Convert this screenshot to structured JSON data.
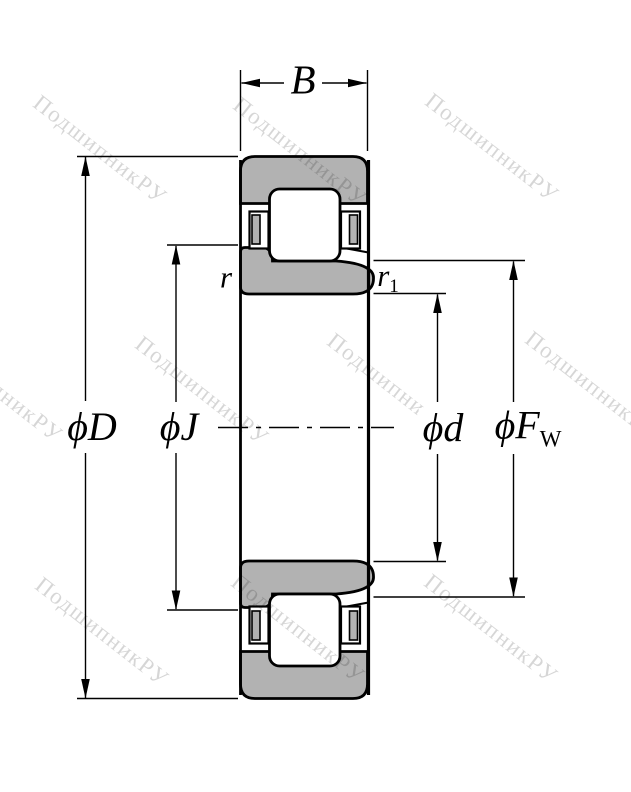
{
  "diagram": {
    "kind": "cylindrical-roller-bearing-cross-section",
    "colors": {
      "background": "#ffffff",
      "ring_fill": "#b2b2b2",
      "line": "#000000",
      "watermark": "rgba(0,0,0,0.16)"
    }
  },
  "labels": {
    "width": "B",
    "outer_diameter": "ϕD",
    "rib_diameter": "ϕJ",
    "bore_diameter": "ϕd",
    "raceway_diameter_main": "ϕF",
    "raceway_diameter_sub": "W",
    "chamfer": "r",
    "chamfer_inner_main": "r",
    "chamfer_inner_sub": "1"
  },
  "watermark": {
    "text": "ПодшипникРУ"
  }
}
